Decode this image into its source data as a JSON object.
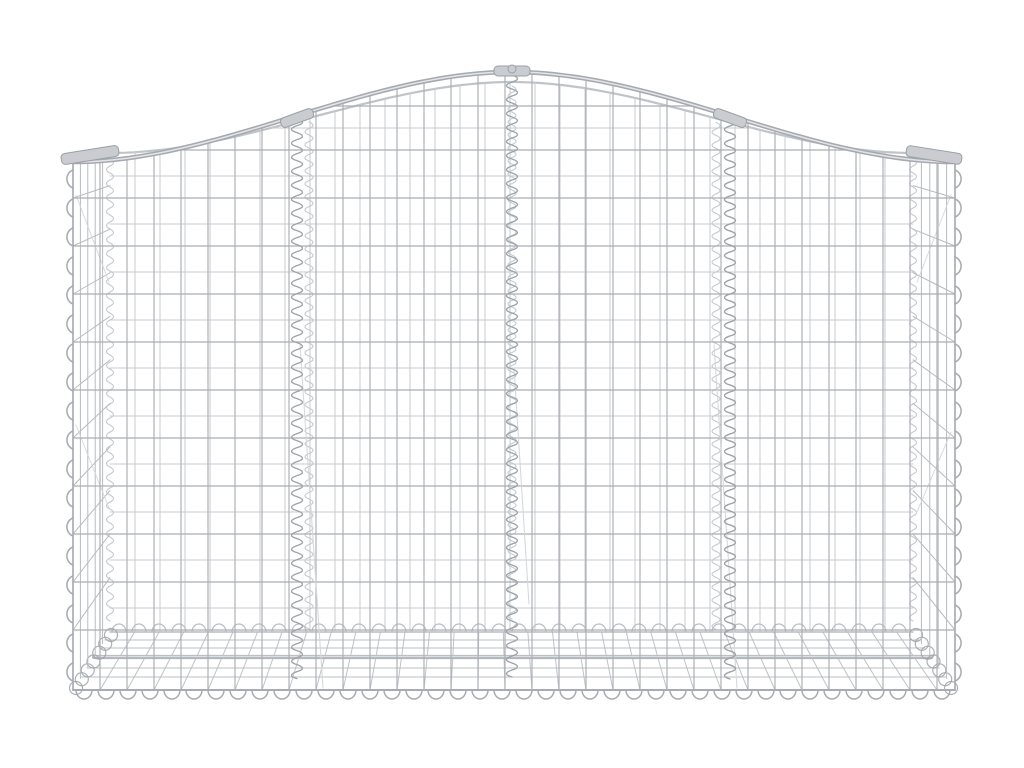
{
  "meta": {
    "description": "Product photo of an arched gabion basket made of galvanised silver wire mesh, four sections joined by vertical spiral wires, on a plain white background",
    "background": "#ffffff"
  },
  "canvas": {
    "width": 1024,
    "height": 768
  },
  "colors": {
    "frontWire": "#a9aeb4",
    "backWire": "#c7cbcf",
    "sideWire": "#b7bcc1",
    "bottomWire": "#b4b9bd",
    "rail": "#a4aab0",
    "railHi": "#e3e5e7",
    "backRail": "#bfc4c8",
    "spiral": "#9da3a9",
    "spiralLight": "#c5c9cd",
    "scallop": "#a6acb2",
    "scallopLight": "#b9bec2",
    "band": "#b1b6ba",
    "bandHi": "#dde0e2",
    "clampFill": "#c9cdd1",
    "clampStroke": "#9aa0a6",
    "diag": "#d4d7da"
  },
  "front": {
    "left": 73,
    "right": 955,
    "bottom": 690,
    "cornerTopY": 162,
    "apexX": 512,
    "apexY": 72,
    "vSpacing": 27,
    "hLines": [
      106,
      150,
      198,
      246,
      294,
      342,
      390,
      438,
      486,
      534,
      582,
      630
    ],
    "dividers": [
      297,
      512,
      730
    ]
  },
  "back": {
    "left": 110,
    "right": 913,
    "bottom": 632,
    "cornerTopY": 153,
    "apexX": 512,
    "apexY": 82,
    "vSpacing": 25,
    "hLines": [
      128,
      176,
      224,
      272,
      320,
      368,
      416,
      464,
      512,
      560,
      608
    ],
    "dividers": [
      309,
      512,
      716
    ]
  },
  "sides": {
    "innerVerticals": 4,
    "leftDiagonals": [
      [
        76,
        195,
        109,
        282
      ],
      [
        76,
        425,
        109,
        508
      ]
    ],
    "rightDiagonals": [
      [
        951,
        195,
        917,
        282
      ],
      [
        951,
        432,
        917,
        512
      ]
    ]
  },
  "bottomPanel": {
    "longWireYs": [
      640,
      648,
      668,
      677
    ],
    "thickBandY": 657,
    "crossSpacing": 27
  },
  "scallops": {
    "bottomStep": 22,
    "bottomR": 8,
    "backStep": 20,
    "backR": 7,
    "sideStep": 29,
    "sideR": 9
  },
  "diagonalBraces": [
    [
      300,
      345,
      323,
      688
    ],
    [
      714,
      345,
      737,
      688
    ],
    [
      514,
      368,
      529,
      604
    ]
  ],
  "clamps": [
    {
      "cx": 90,
      "cy": 155,
      "w": 58,
      "h": 11,
      "angle": -9
    },
    {
      "cx": 297,
      "cy": 118,
      "w": 34,
      "h": 10,
      "angle": -20
    },
    {
      "cx": 512,
      "cy": 71,
      "w": 36,
      "h": 10,
      "angle": 0
    },
    {
      "cx": 730,
      "cy": 118,
      "w": 34,
      "h": 10,
      "angle": 20
    },
    {
      "cx": 934,
      "cy": 155,
      "w": 56,
      "h": 11,
      "angle": 9
    }
  ],
  "cornerSpirals": {
    "leftX": 73,
    "rightX": 955,
    "yTop": 170,
    "yBottom": 682
  },
  "cornerJoints": {
    "left": {
      "x1": 76,
      "y1": 688,
      "x2": 111,
      "y2": 635,
      "count": 7,
      "r": 6.5
    },
    "right": {
      "x1": 951,
      "y1": 688,
      "x2": 916,
      "y2": 635,
      "count": 7,
      "r": 6.5
    }
  }
}
